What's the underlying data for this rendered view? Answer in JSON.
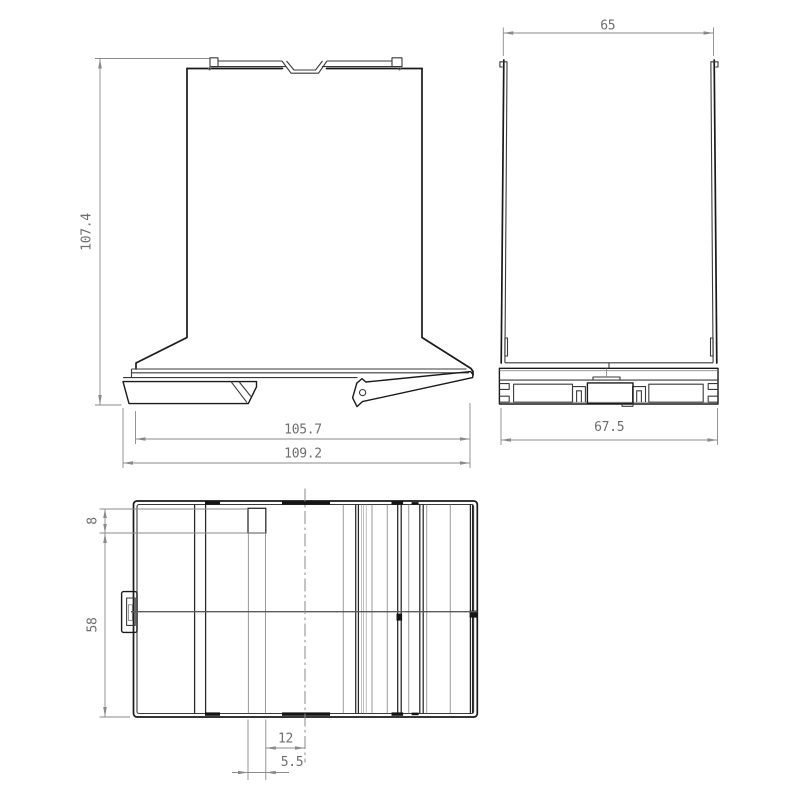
{
  "drawing": {
    "type": "technical-drawing",
    "subject": "DIN-rail enclosure, three orthographic views with dimensions",
    "units": "mm",
    "views": {
      "front": {
        "label": "front-view",
        "dimensions": {
          "height": "107.4",
          "base_width": "105.7",
          "overall_width": "109.2"
        }
      },
      "side": {
        "label": "side-view",
        "dimensions": {
          "top_width": "65",
          "base_width": "67.5"
        }
      },
      "top": {
        "label": "top-view",
        "dimensions": {
          "slot_depth": "8",
          "body_depth": "58",
          "slot_to_center": "12",
          "slot_width": "5.5"
        }
      }
    },
    "colors": {
      "background": "#ffffff",
      "outline": "#1a1a1a",
      "detail": "#3a3a3a",
      "fine_line": "#9a9a9a",
      "dimension": "#8a8a8a",
      "dimension_text": "#6e6e6e"
    }
  }
}
